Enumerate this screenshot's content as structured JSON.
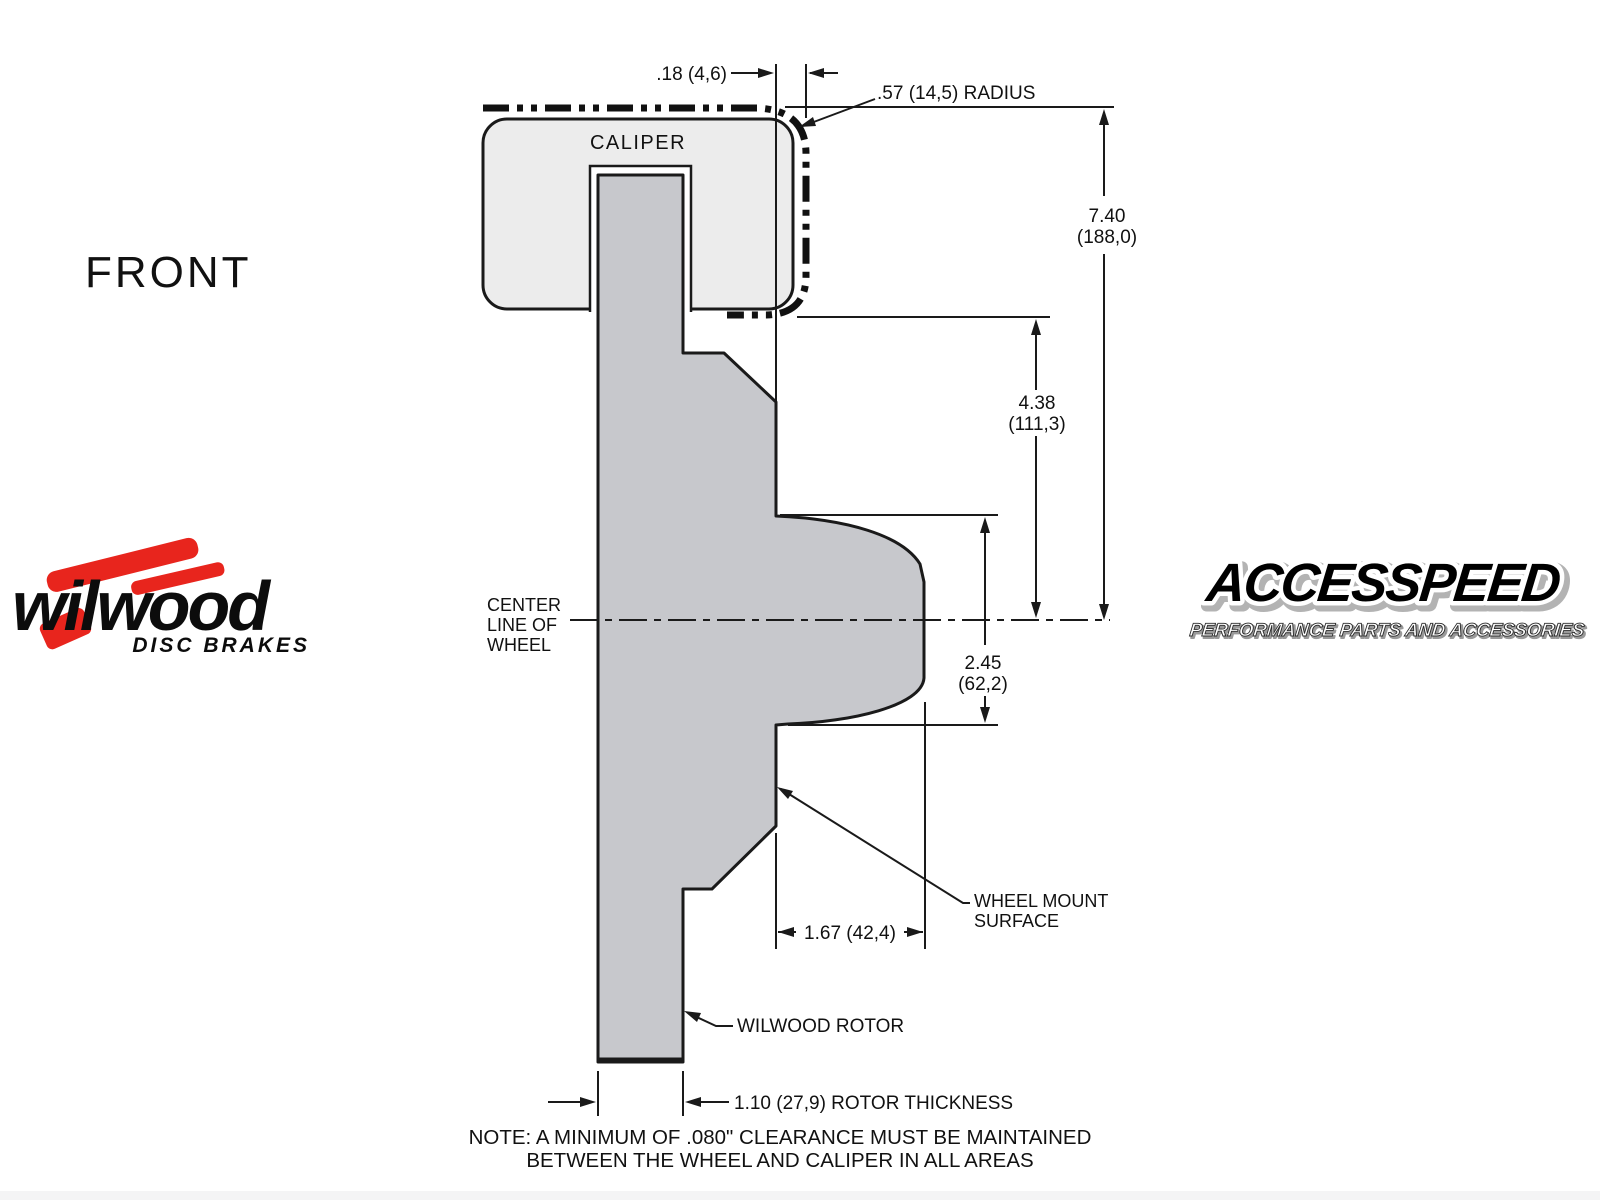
{
  "view_label": "FRONT",
  "colors": {
    "line": "#1a1a1a",
    "rotor_fill": "#c7c8cc",
    "caliper_fill": "#ececec",
    "logo_red": "#e8251d",
    "band": "#f4f4f5"
  },
  "drawing": {
    "caliper_label": "CALIPER",
    "centerline": {
      "l1": "CENTER",
      "l2": "LINE OF",
      "l3": "WHEEL"
    },
    "dims": {
      "caliper_wheel_gap": ".18 (4,6)",
      "wheel_radius": ".57 (14,5) RADIUS",
      "overall": {
        "in": "7.40",
        "mm": "(188,0)"
      },
      "caliper_bottom_to_center": {
        "in": "4.38",
        "mm": "(111,3)"
      },
      "hub": {
        "in": "2.45",
        "mm": "(62,2)"
      },
      "hub_depth": "1.67 (42,4)",
      "rotor_thickness": "1.10 (27,9) ROTOR THICKNESS"
    },
    "callouts": {
      "wheel_mount": {
        "l1": "WHEEL MOUNT",
        "l2": "SURFACE"
      },
      "rotor": "WILWOOD ROTOR"
    },
    "note": {
      "l1": "NOTE: A MINIMUM OF .080\" CLEARANCE MUST BE MAINTAINED",
      "l2": "BETWEEN THE WHEEL AND CALIPER IN ALL AREAS"
    }
  },
  "logos": {
    "wilwood": {
      "wordmark": "wilwood",
      "tagline": "DISC BRAKES"
    },
    "accesspeed": {
      "wordmark": "ACCESSPEED",
      "tagline": "PERFORMANCE PARTS AND ACCESSORIES"
    }
  }
}
